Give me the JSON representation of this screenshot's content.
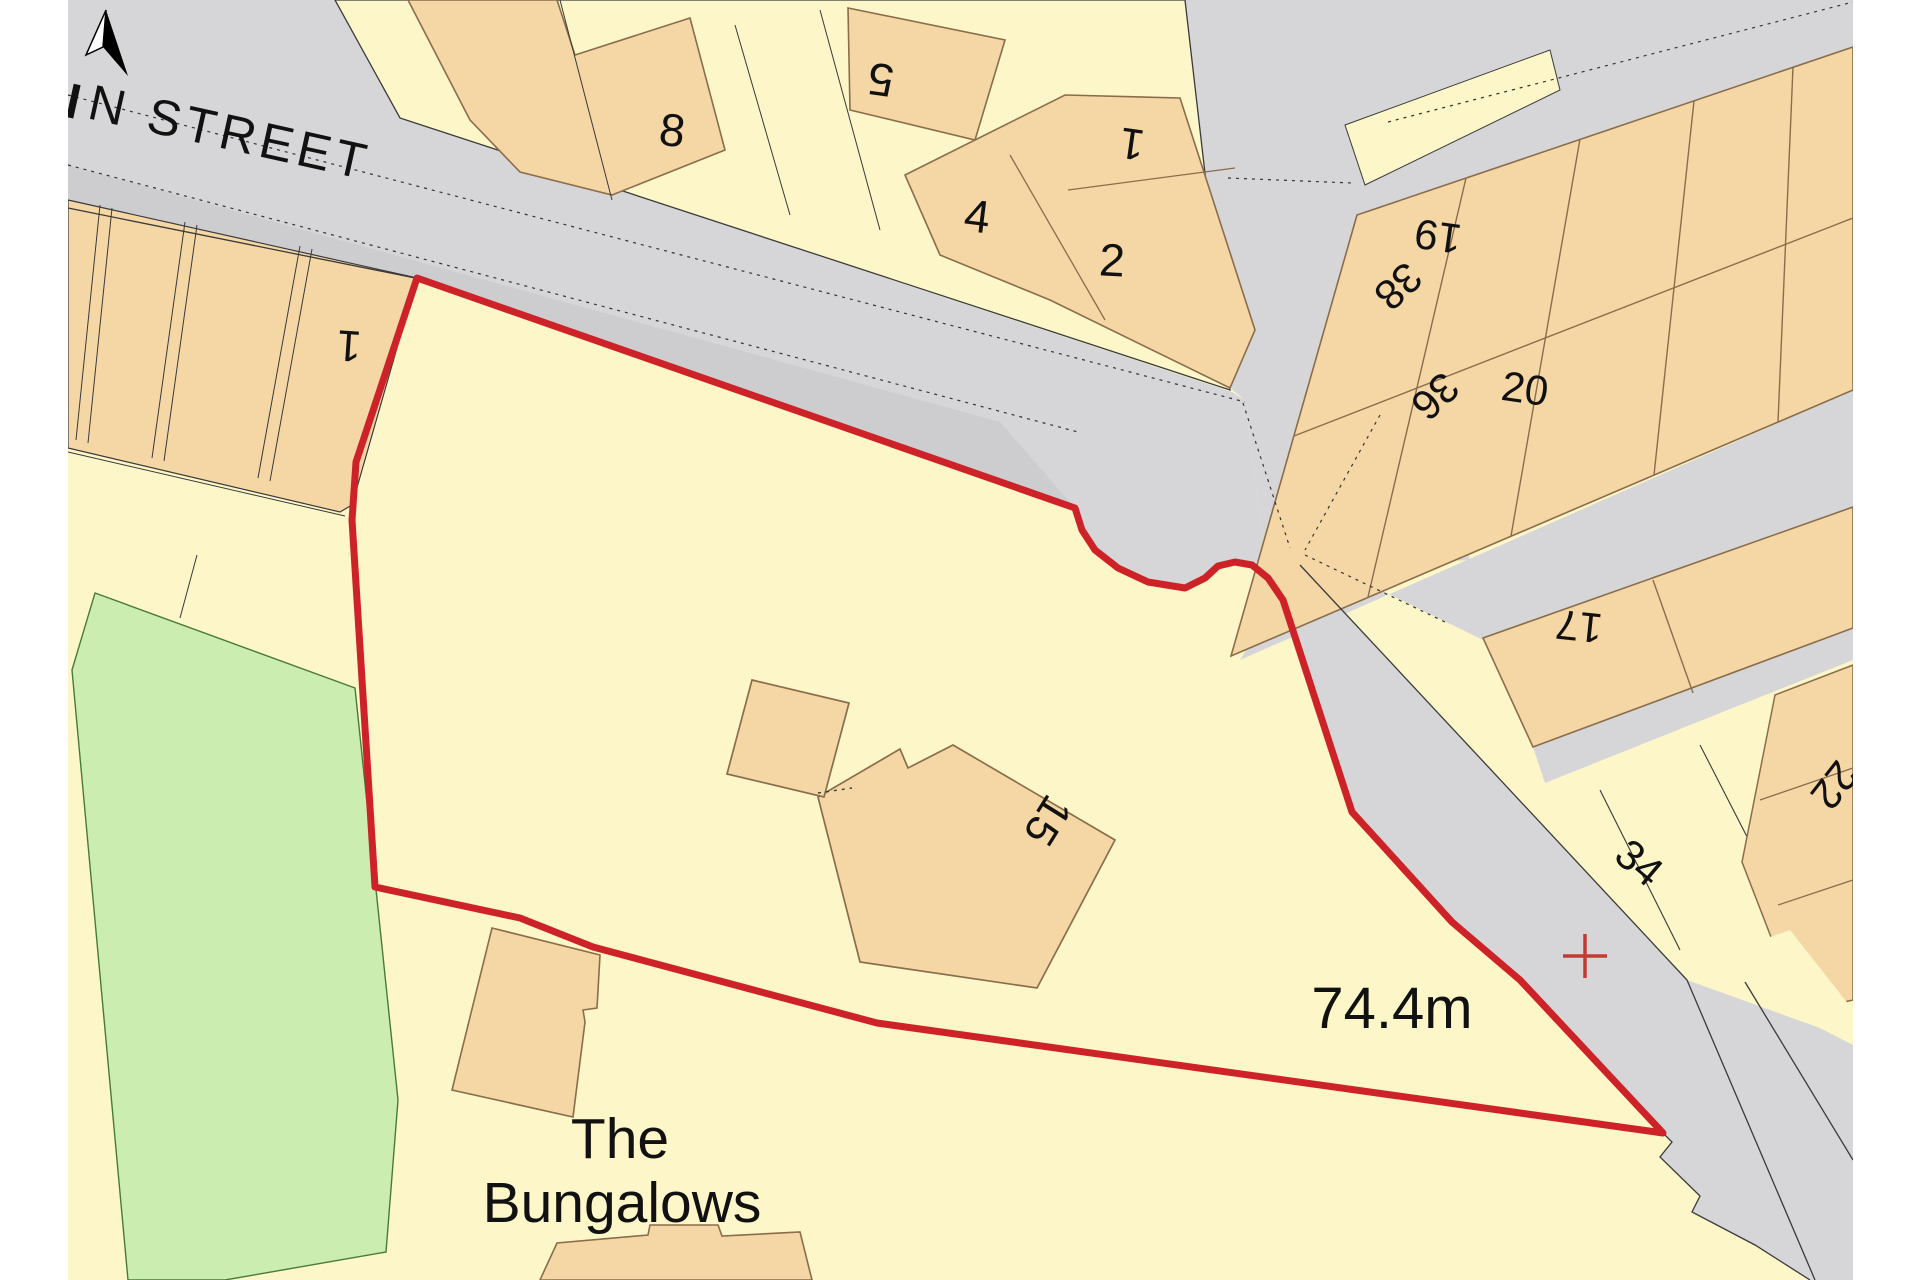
{
  "map": {
    "street_label": "N STREET",
    "spot_height_label": "74.4m",
    "place_label": {
      "line1": "The",
      "line2": "Bungalows"
    },
    "site": {
      "building_number": "15",
      "boundary_color": "#cd2328"
    },
    "icons": {
      "north_arrow": "north-arrow-icon",
      "benchmark_cross": "benchmark-cross-icon"
    },
    "colors": {
      "plot_cream": "#fcf6c8",
      "building_peach": "#f5d7a6",
      "road_gray": "#d6d6d8",
      "road_lane_gray": "#cbcbcd",
      "green_space": "#cbedaf",
      "boundary_red": "#cd2328",
      "line_dark": "#3a3a3a",
      "building_outline": "#8a6d4a"
    },
    "labels": [
      {
        "text": "8"
      },
      {
        "text": "5"
      },
      {
        "text": "4"
      },
      {
        "text": "1"
      },
      {
        "text": "2"
      },
      {
        "text": "1"
      },
      {
        "text": "19"
      },
      {
        "text": "38"
      },
      {
        "text": "36"
      },
      {
        "text": "20"
      },
      {
        "text": "17"
      },
      {
        "text": "34"
      },
      {
        "text": "22"
      },
      {
        "text": "15"
      }
    ]
  }
}
